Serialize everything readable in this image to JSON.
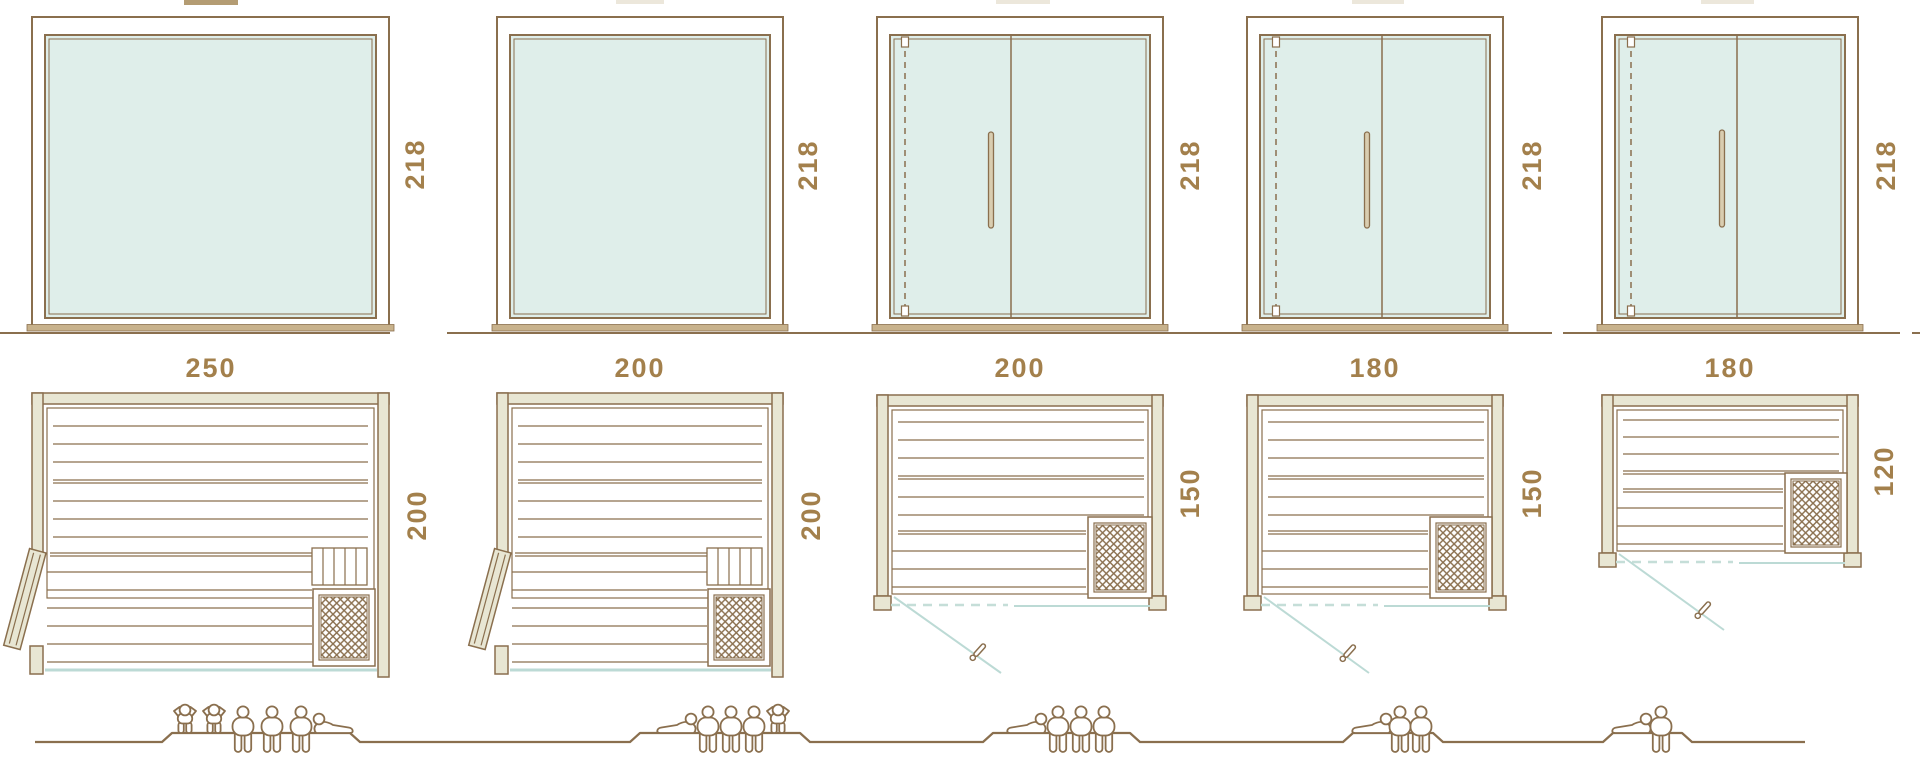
{
  "diagram": {
    "description": "Sauna cabin size range diagram: front glass elevations (top), floor plans (middle), seating capacity figures (bottom)",
    "units": "cm",
    "colors": {
      "outline_brown": "#8a6f4e",
      "dimension_text": "#a3804c",
      "wood_fill": "#e8e6d3",
      "glass_fill": "#dfeeea",
      "glass_line_teal": "#bcdad5",
      "sill_tan": "#c8b28c"
    },
    "icons": {
      "standing": "person-standing-icon",
      "sitting": "person-sitting-icon",
      "lying": "person-lying-icon"
    },
    "saunas": [
      {
        "width_label": "250",
        "height_label": "218",
        "depth_label": "200",
        "capacity": {
          "standing": 2,
          "sitting": 3,
          "lying": 1,
          "total": 6
        }
      },
      {
        "width_label": "200",
        "height_label": "218",
        "depth_label": "200",
        "capacity": {
          "standing": 1,
          "sitting": 3,
          "lying": 1,
          "total": 5
        }
      },
      {
        "width_label": "200",
        "height_label": "218",
        "depth_label": "150",
        "capacity": {
          "standing": 0,
          "sitting": 3,
          "lying": 1,
          "total": 4
        }
      },
      {
        "width_label": "180",
        "height_label": "218",
        "depth_label": "150",
        "capacity": {
          "standing": 0,
          "sitting": 2,
          "lying": 1,
          "total": 3
        }
      },
      {
        "width_label": "180",
        "height_label": "218",
        "depth_label": "120",
        "capacity": {
          "standing": 0,
          "sitting": 1,
          "lying": 1,
          "total": 2
        }
      }
    ]
  }
}
